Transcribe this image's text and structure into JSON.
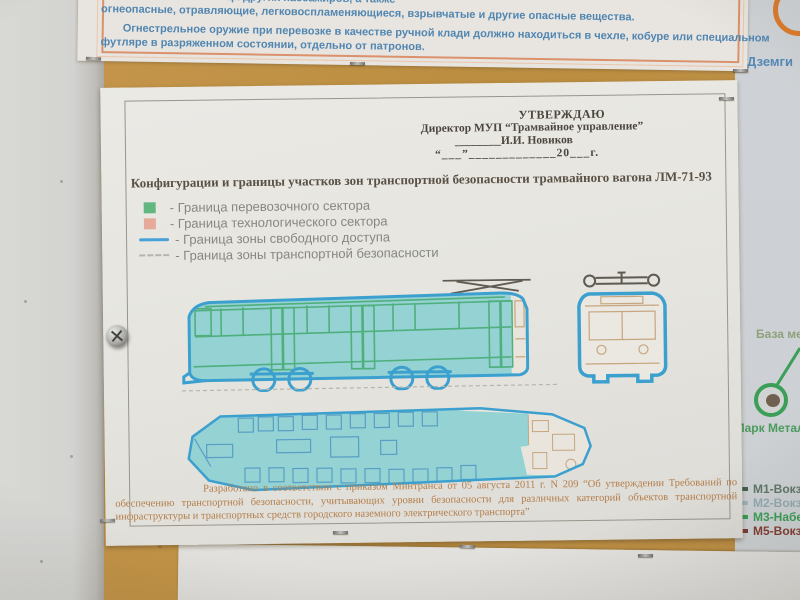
{
  "top_document": {
    "line1": "вещи других пассажиров, а также",
    "line2": "огнеопасные, отравляющие, легковоспламеняющиеся, взрывчатые и другие опасные вещества.",
    "line3": "Огнестрельное оружие при перевозке в качестве ручной клади должно находиться в чехле, кобуре или специальном",
    "line4": "футляре в разряженном состоянии, отдельно от патронов.",
    "text_color": "#4783b3",
    "border_color": "#e08d62"
  },
  "main_document": {
    "approval": {
      "line1": "УТВЕРЖДАЮ",
      "line2": "Директор МУП “Трамвайное управление”",
      "line3": "________И.И. Новиков",
      "line4": "“___”_____________20___г."
    },
    "title": "Конфигурации и границы участков зон транспортной безопасности трамвайного вагона ЛМ-71-93",
    "legend": [
      {
        "marker": "green-square",
        "color": "#58b87a",
        "label": "- Граница перевозочного сектора"
      },
      {
        "marker": "salmon-square",
        "color": "#e9a795",
        "label": "- Граница технологического сектора"
      },
      {
        "marker": "blue-line",
        "color": "#3ca0de",
        "label": "- Граница зоны свободного доступа"
      },
      {
        "marker": "gray-dashed-line",
        "color": "#b4b4aa",
        "label": "- Граница зоны транспортной безопасности"
      }
    ],
    "diagram_colors": {
      "outline_blue": "#2f9fd4",
      "fill_cyan": "#8dd4d6",
      "detail_green": "#44b077",
      "detail_tan": "#c8a478"
    },
    "footer": "Разработано в соответствии с приказом Минтранса от 05 августа 2011 г. N 209 “Об утверждении Требований по обеспечению транспортной безопасности, учитывающих уровни безопасности для различных категорий объектов транспортной инфраструктуры и транспортных средств городского наземного электрического транспорта”"
  },
  "side_map": {
    "station_top": "Дземги",
    "label_base": "База мет",
    "label_park": "Парк Металлу",
    "routes": [
      {
        "label": "М1-Вокзал",
        "color": "#3d5c49"
      },
      {
        "label": "М2-Вокзал",
        "color": "#9bb4bc"
      },
      {
        "label": "М3-Набереж",
        "color": "#2f9e4f"
      },
      {
        "label": "М5-Вокзал",
        "color": "#7e352c"
      }
    ]
  }
}
